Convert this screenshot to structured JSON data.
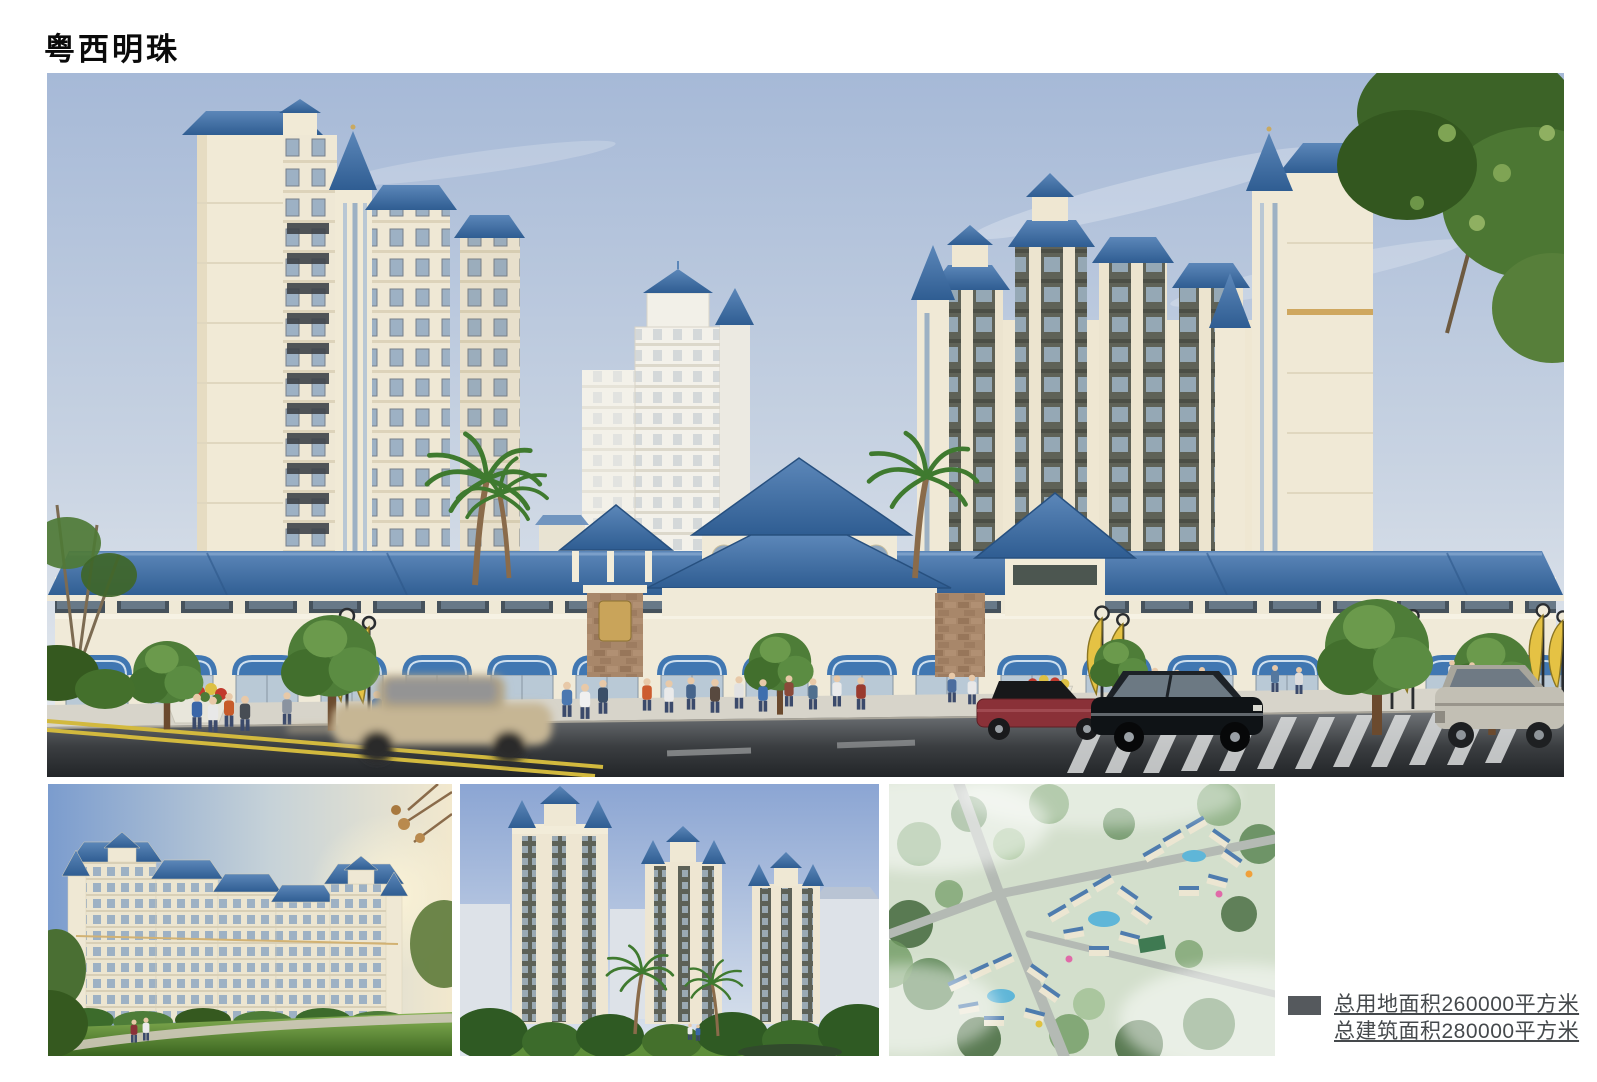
{
  "page": {
    "title": "粤西明珠",
    "background": "#ffffff"
  },
  "stats": {
    "lines": [
      "总用地面积260000平方米",
      "总建筑面积280000平方米"
    ],
    "bullet_color": "#55595d",
    "text_color": "#45494c"
  },
  "figures": {
    "main": "street-elevation-rendering",
    "thumb1": "garden-elevation-rendering",
    "thumb2": "towers-landscape-rendering",
    "thumb3": "aerial-masterplan-rendering"
  },
  "palette": {
    "roof_blue": "#3a6ca5",
    "wall_cream": "#f1ead6",
    "sky_top": "#a6b9d7",
    "sky_bottom": "#eaedf0",
    "road_dark": "#222528",
    "awning_blue": "#4077b2",
    "banner_yellow": "#e5c244",
    "tree_green": "#4e7d38",
    "stone_brown": "#a8876a"
  }
}
